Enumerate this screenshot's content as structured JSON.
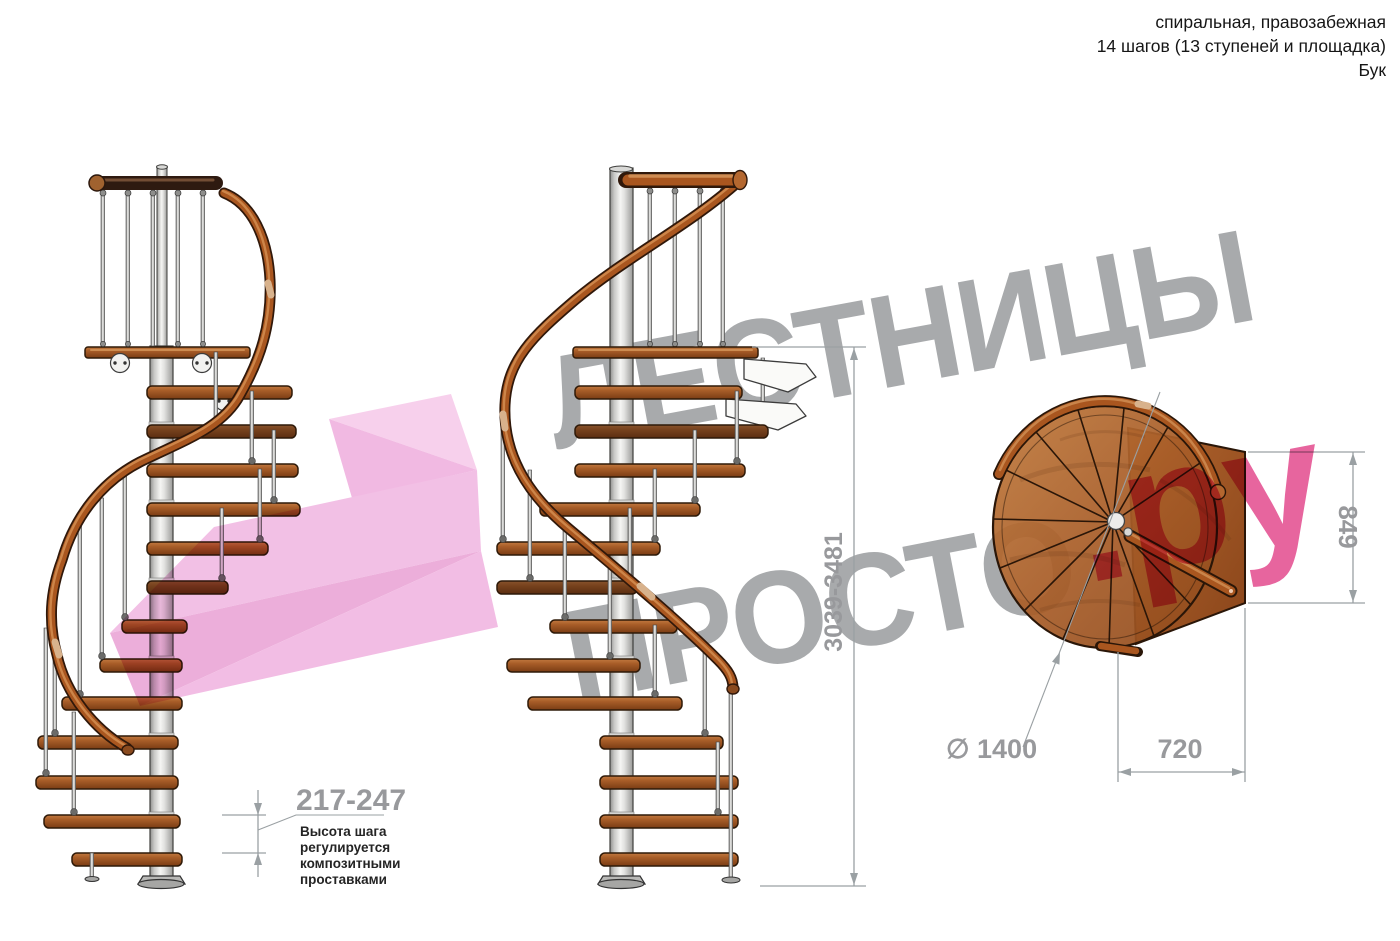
{
  "header": {
    "line1": "спиральная, правозабежная",
    "line2": "14 шагов (13 ступеней и площадка)",
    "line3": "Бук"
  },
  "watermark": {
    "word1": "ЛЕСТНИЦЫ",
    "word2": "ПРОСТО",
    "suffix": ".ру"
  },
  "dims": {
    "step_height": "217-247",
    "note_lines": [
      "Высота шага",
      "регулируется",
      "композитными",
      "проставками"
    ],
    "total_height": "3039-3481",
    "landing_depth": "849",
    "tread_run": "720",
    "diameter": "∅ 1400"
  },
  "colors": {
    "wood": "#a85d28",
    "wood_dark": "#7a3c14",
    "pole_metal": "#e8e8e6",
    "dimension_gray": "#98999c",
    "watermark_gray": "#a8aaac",
    "accent_pink": "#e13e86",
    "arrow_pink": "#f0aede"
  }
}
